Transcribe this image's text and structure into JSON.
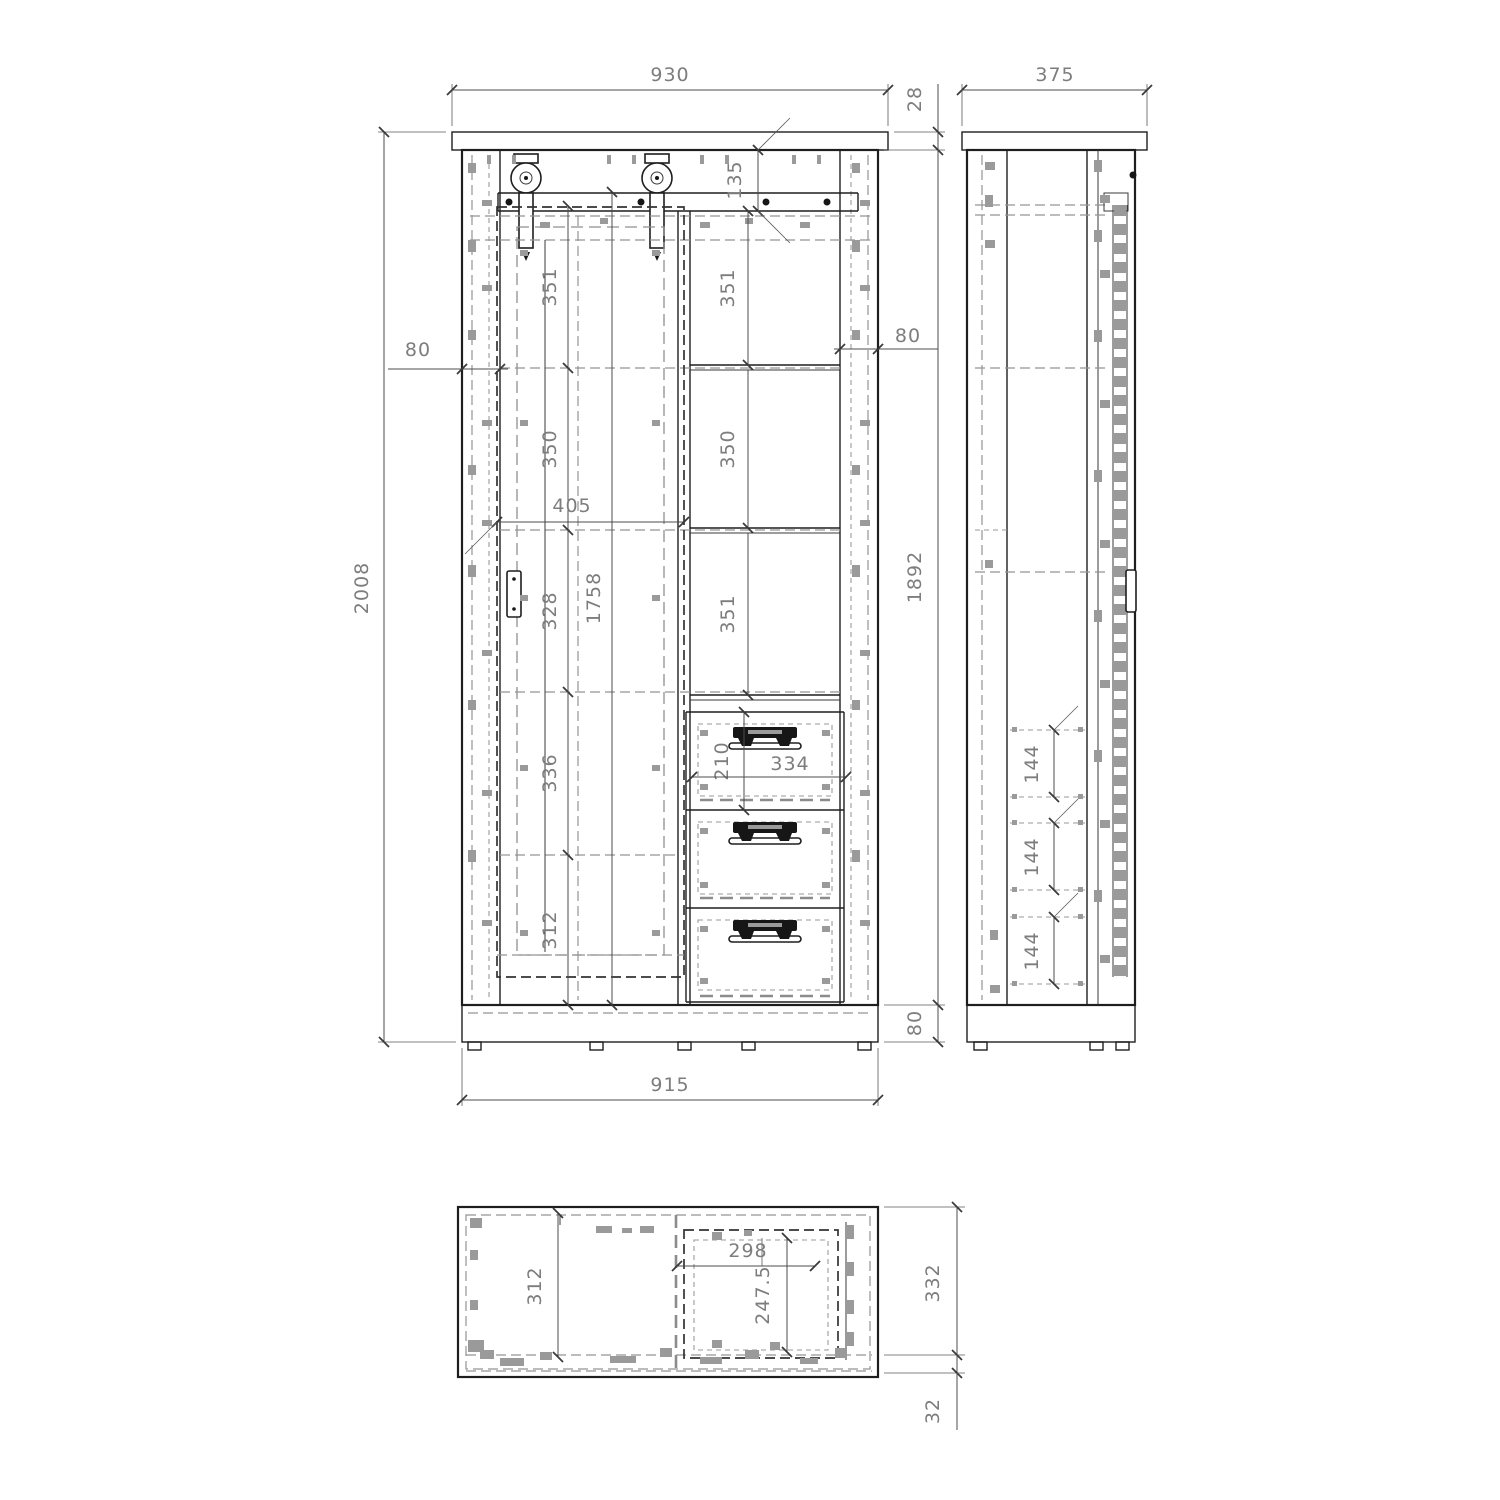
{
  "drawing_type": "furniture-technical-drawing",
  "colors": {
    "background": "#ffffff",
    "solid_line": "#1e1e1e",
    "hidden_line": "#949494",
    "dimension_text": "#7d7d7d"
  },
  "front": {
    "dims": {
      "overall_width": "930",
      "top_thickness": "28",
      "overall_height": "2008",
      "rail_height": "135",
      "left_stile": "80",
      "right_stile": "80",
      "left_sections": [
        "351",
        "350",
        "328",
        "336",
        "312"
      ],
      "left_total": "1758",
      "door_width": "405",
      "right_sections": [
        "351",
        "350",
        "351"
      ],
      "carcass_height": "1892",
      "plinth_height": "80",
      "drawer_height": "210",
      "drawer_width": "334",
      "base_width": "915"
    }
  },
  "side": {
    "dims": {
      "depth": "375",
      "drawer_pitch": [
        "144",
        "144",
        "144"
      ]
    }
  },
  "top": {
    "dims": {
      "interior_depth": "312",
      "drawer_opening_width": "298",
      "drawer_depth": "247.5",
      "carcass_depth": "332",
      "door_thickness": "32"
    }
  }
}
